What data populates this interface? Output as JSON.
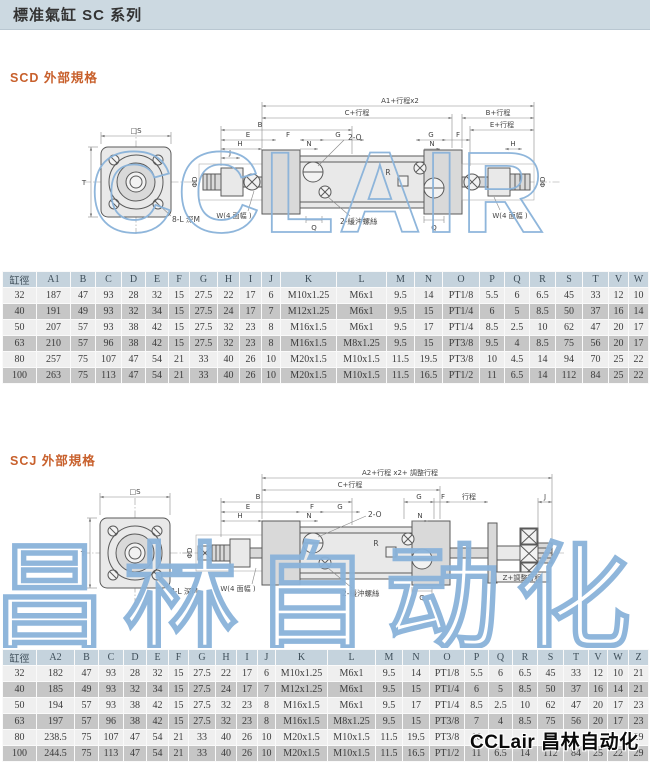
{
  "page": {
    "title": "標准氣缸 SC 系列"
  },
  "colors": {
    "header_bar_bg": "#ccd9e1",
    "section_heading": "#c8602c",
    "table_header_bg": "#c5d3dd",
    "row_light": "#efefef",
    "row_dark": "#c6c6c6",
    "watermark_blue": "#8ab3da"
  },
  "watermarks": {
    "big1": "CCLAIR",
    "big2": "昌林自动化",
    "corner": "CCLair 昌林自动化"
  },
  "scd": {
    "heading": "SCD 外部規格",
    "labels": {
      "sq": "□S",
      "t": "T",
      "holes": "8-L 深M",
      "a1": "A1+行程x2",
      "c": "C+行程",
      "b2": "B+行程",
      "e2": "E+行程",
      "b": "B",
      "e": "E",
      "f": "F",
      "g": "G",
      "h": "H",
      "j": "J",
      "n": "N",
      "g2": "G",
      "f2": "F",
      "n2": "N",
      "h2": "H",
      "ports": "2-O",
      "cushion": "2-緩沖螺絲",
      "r": "R",
      "q": "Q",
      "q2": "Q",
      "w_left": "W(4 面幅 )",
      "w_right": "W(4 面幅 )",
      "phid_l": "ΦD",
      "phid_r": "ΦD"
    },
    "table": {
      "col_weights": [
        34,
        34,
        25,
        26,
        24,
        23,
        21,
        28,
        22,
        22,
        19,
        56,
        50,
        28,
        28,
        37,
        25,
        25,
        26,
        27,
        26,
        20,
        20
      ],
      "columns": [
        "缸徑",
        "A1",
        "B",
        "C",
        "D",
        "E",
        "F",
        "G",
        "H",
        "I",
        "J",
        "K",
        "L",
        "M",
        "N",
        "O",
        "P",
        "Q",
        "R",
        "S",
        "T",
        "V",
        "W"
      ],
      "rows": [
        [
          "32",
          "187",
          "47",
          "93",
          "28",
          "32",
          "15",
          "27.5",
          "22",
          "17",
          "6",
          "M10x1.25",
          "M6x1",
          "9.5",
          "14",
          "PT1/8",
          "5.5",
          "6",
          "6.5",
          "45",
          "33",
          "12",
          "10"
        ],
        [
          "40",
          "191",
          "49",
          "93",
          "32",
          "34",
          "15",
          "27.5",
          "24",
          "17",
          "7",
          "M12x1.25",
          "M6x1",
          "9.5",
          "15",
          "PT1/4",
          "6",
          "5",
          "8.5",
          "50",
          "37",
          "16",
          "14"
        ],
        [
          "50",
          "207",
          "57",
          "93",
          "38",
          "42",
          "15",
          "27.5",
          "32",
          "23",
          "8",
          "M16x1.5",
          "M6x1",
          "9.5",
          "17",
          "PT1/4",
          "8.5",
          "2.5",
          "10",
          "62",
          "47",
          "20",
          "17"
        ],
        [
          "63",
          "210",
          "57",
          "96",
          "38",
          "42",
          "15",
          "27.5",
          "32",
          "23",
          "8",
          "M16x1.5",
          "M8x1.25",
          "9.5",
          "15",
          "PT3/8",
          "9.5",
          "4",
          "8.5",
          "75",
          "56",
          "20",
          "17"
        ],
        [
          "80",
          "257",
          "75",
          "107",
          "47",
          "54",
          "21",
          "33",
          "40",
          "26",
          "10",
          "M20x1.5",
          "M10x1.5",
          "11.5",
          "19.5",
          "PT3/8",
          "10",
          "4.5",
          "14",
          "94",
          "70",
          "25",
          "22"
        ],
        [
          "100",
          "263",
          "75",
          "113",
          "47",
          "54",
          "21",
          "33",
          "40",
          "26",
          "10",
          "M20x1.5",
          "M10x1.5",
          "11.5",
          "16.5",
          "PT1/2",
          "11",
          "6.5",
          "14",
          "112",
          "84",
          "25",
          "22"
        ]
      ]
    }
  },
  "scj": {
    "heading": "SCJ 外部規格",
    "labels": {
      "sq": "□S",
      "t": "T",
      "holes": "8-L 深M",
      "a2": "A2+行程 x2+ 調整行程",
      "c": "C+行程",
      "b": "B",
      "e": "E",
      "f": "F",
      "g": "G",
      "h": "H",
      "n": "N",
      "g2": "G",
      "f2": "F",
      "n2": "N",
      "stroke": "行程",
      "j2": "J",
      "z": "Z+調整行程",
      "ports": "2-O",
      "cushion": "2-緩沖螺絲",
      "r": "R",
      "q": "Q",
      "w_left": "W(4 面幅 )",
      "phid": "ΦD"
    },
    "table": {
      "col_weights": [
        34,
        38,
        24,
        25,
        23,
        22,
        20,
        27,
        21,
        21,
        18,
        52,
        48,
        27,
        27,
        35,
        24,
        24,
        25,
        26,
        25,
        19,
        21,
        20
      ],
      "columns": [
        "缸徑",
        "A2",
        "B",
        "C",
        "D",
        "E",
        "F",
        "G",
        "H",
        "I",
        "J",
        "K",
        "L",
        "M",
        "N",
        "O",
        "P",
        "Q",
        "R",
        "S",
        "T",
        "V",
        "W",
        "Z"
      ],
      "rows": [
        [
          "32",
          "182",
          "47",
          "93",
          "28",
          "32",
          "15",
          "27.5",
          "22",
          "17",
          "6",
          "M10x1.25",
          "M6x1",
          "9.5",
          "14",
          "PT1/8",
          "5.5",
          "6",
          "6.5",
          "45",
          "33",
          "12",
          "10",
          "21"
        ],
        [
          "40",
          "185",
          "49",
          "93",
          "32",
          "34",
          "15",
          "27.5",
          "24",
          "17",
          "7",
          "M12x1.25",
          "M6x1",
          "9.5",
          "15",
          "PT1/4",
          "6",
          "5",
          "8.5",
          "50",
          "37",
          "16",
          "14",
          "21"
        ],
        [
          "50",
          "194",
          "57",
          "93",
          "38",
          "42",
          "15",
          "27.5",
          "32",
          "23",
          "8",
          "M16x1.5",
          "M6x1",
          "9.5",
          "17",
          "PT1/4",
          "8.5",
          "2.5",
          "10",
          "62",
          "47",
          "20",
          "17",
          "23"
        ],
        [
          "63",
          "197",
          "57",
          "96",
          "38",
          "42",
          "15",
          "27.5",
          "32",
          "23",
          "8",
          "M16x1.5",
          "M8x1.25",
          "9.5",
          "15",
          "PT3/8",
          "7",
          "4",
          "8.5",
          "75",
          "56",
          "20",
          "17",
          "23"
        ],
        [
          "80",
          "238.5",
          "75",
          "107",
          "47",
          "54",
          "21",
          "33",
          "40",
          "26",
          "10",
          "M20x1.5",
          "M10x1.5",
          "11.5",
          "19.5",
          "PT3/8",
          "10",
          "",
          "",
          "",
          "",
          "",
          "",
          "29"
        ],
        [
          "100",
          "244.5",
          "75",
          "113",
          "47",
          "54",
          "21",
          "33",
          "40",
          "26",
          "10",
          "M20x1.5",
          "M10x1.5",
          "11.5",
          "16.5",
          "PT1/2",
          "11",
          "6.5",
          "14",
          "112",
          "84",
          "25",
          "22",
          "29"
        ]
      ]
    }
  }
}
